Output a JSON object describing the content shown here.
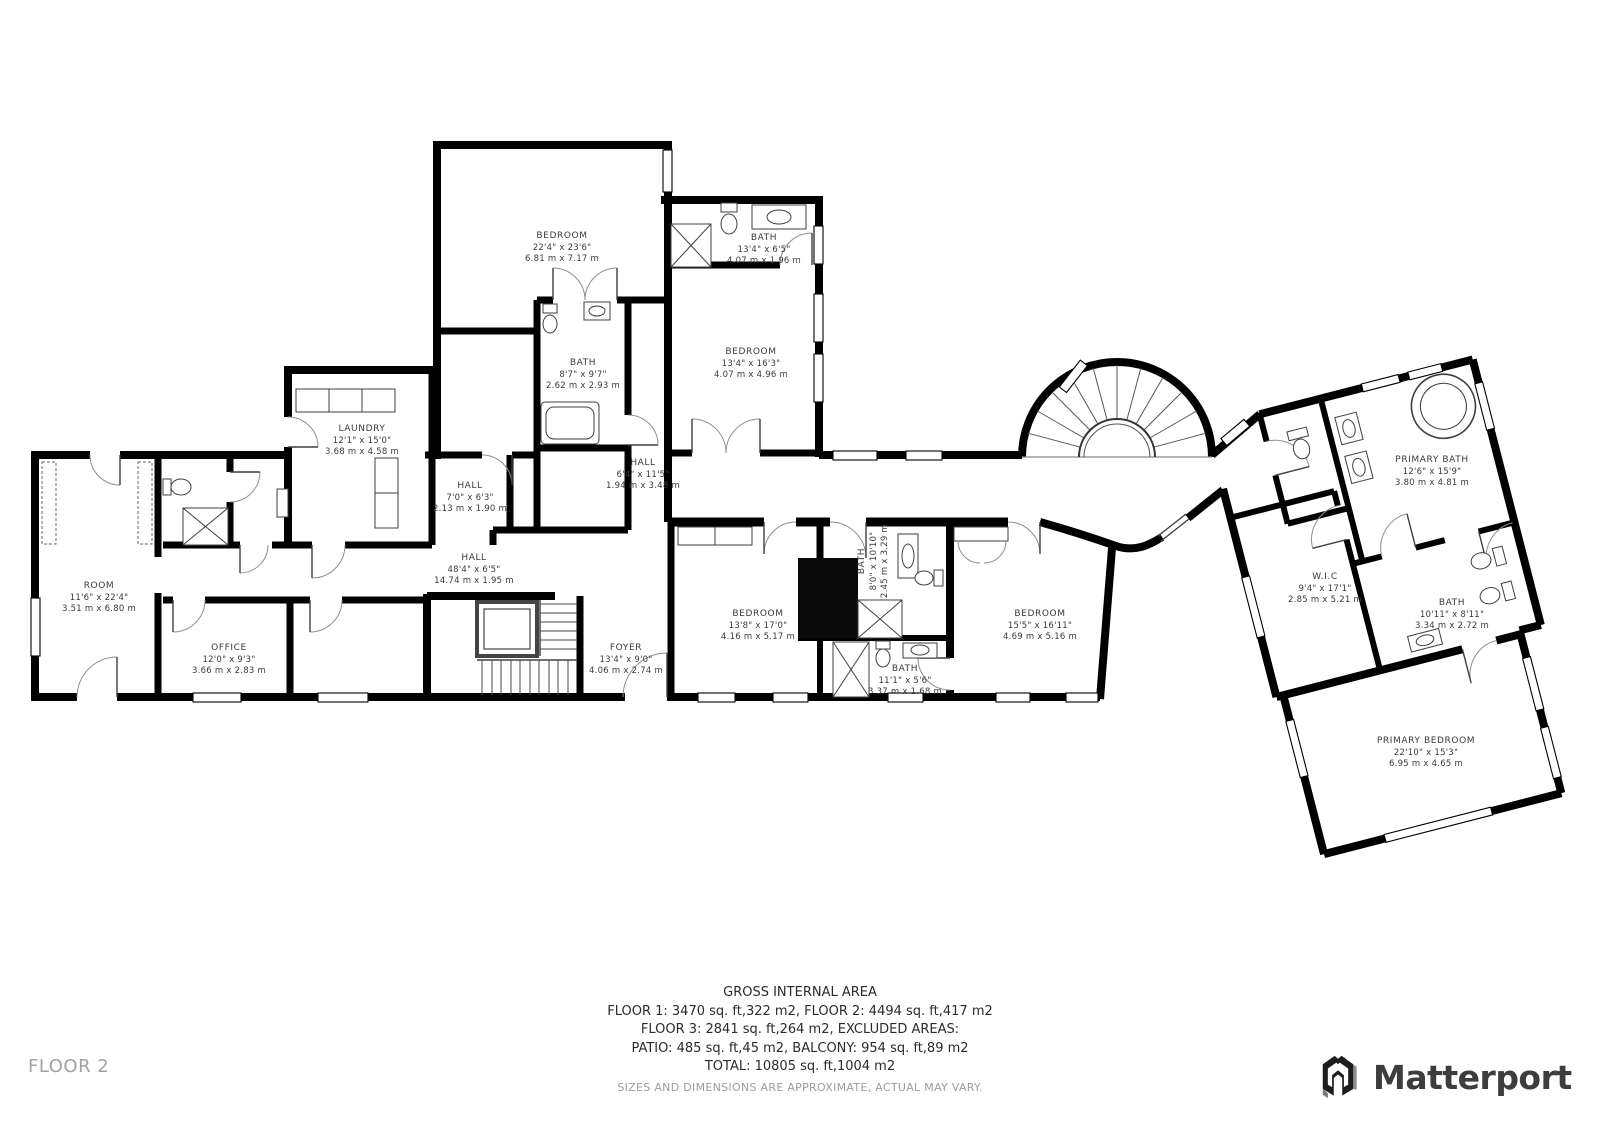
{
  "page": {
    "floor_label": "FLOOR 2"
  },
  "brand": {
    "name": "Matterport"
  },
  "footer": {
    "title": "GROSS INTERNAL AREA",
    "line1": "FLOOR 1: 3470 sq. ft,322 m2, FLOOR 2: 4494 sq. ft,417 m2",
    "line2": "FLOOR 3: 2841 sq. ft,264 m2, EXCLUDED AREAS:",
    "line3": "PATIO: 485 sq. ft,45 m2, BALCONY: 954 sq. ft,89 m2",
    "line4": "TOTAL: 10805 sq. ft,1004 m2",
    "disclaimer": "SIZES AND DIMENSIONS ARE APPROXIMATE, ACTUAL MAY VARY."
  },
  "colors": {
    "wall": "#000000",
    "label": "#3a3a3a",
    "muted": "#a2a2a2",
    "brand": "#3d3d3d"
  },
  "rooms": [
    {
      "id": "bedroom-top",
      "name": "BEDROOM",
      "imperial": "22'4\" x 23'6\"",
      "metric": "6.81 m x 7.17 m",
      "x": 562,
      "y": 248,
      "rot": 0
    },
    {
      "id": "bath-top",
      "name": "BATH",
      "imperial": "13'4\" x 6'5\"",
      "metric": "4.07 m x 1.96 m",
      "x": 764,
      "y": 250,
      "rot": 0
    },
    {
      "id": "bedroom-east",
      "name": "BEDROOM",
      "imperial": "13'4\" x 16'3\"",
      "metric": "4.07 m x 4.96 m",
      "x": 751,
      "y": 364,
      "rot": 0
    },
    {
      "id": "bath-center",
      "name": "BATH",
      "imperial": "8'7\" x 9'7\"",
      "metric": "2.62 m x 2.93 m",
      "x": 583,
      "y": 375,
      "rot": 0
    },
    {
      "id": "laundry",
      "name": "LAUNDRY",
      "imperial": "12'1\" x 15'0\"",
      "metric": "3.68 m x 4.58 m",
      "x": 362,
      "y": 441,
      "rot": 0
    },
    {
      "id": "hall-small",
      "name": "HALL",
      "imperial": "7'0\" x 6'3\"",
      "metric": "2.13 m x 1.90 m",
      "x": 470,
      "y": 498,
      "rot": 0
    },
    {
      "id": "hall-mid",
      "name": "HALL",
      "imperial": "6'4\" x 11'5\"",
      "metric": "1.94 m x 3.48 m",
      "x": 643,
      "y": 475,
      "rot": 0
    },
    {
      "id": "hall-long",
      "name": "HALL",
      "imperial": "48'4\" x 6'5\"",
      "metric": "14.74 m x 1.95 m",
      "x": 474,
      "y": 570,
      "rot": 0
    },
    {
      "id": "room-west",
      "name": "ROOM",
      "imperial": "11'6\" x 22'4\"",
      "metric": "3.51 m x 6.80 m",
      "x": 99,
      "y": 598,
      "rot": 0
    },
    {
      "id": "office",
      "name": "OFFICE",
      "imperial": "12'0\" x 9'3\"",
      "metric": "3.66 m x 2.83 m",
      "x": 229,
      "y": 660,
      "rot": 0
    },
    {
      "id": "foyer",
      "name": "FOYER",
      "imperial": "13'4\" x 9'0\"",
      "metric": "4.06 m x 2.74 m",
      "x": 626,
      "y": 660,
      "rot": 0
    },
    {
      "id": "bedroom-center",
      "name": "BEDROOM",
      "imperial": "13'8\" x 17'0\"",
      "metric": "4.16 m x 5.17 m",
      "x": 758,
      "y": 626,
      "rot": 0
    },
    {
      "id": "bath-vertical",
      "name": "BATH",
      "imperial": "8'0\" x 10'10\"",
      "metric": "2.45 m x 3.29 m",
      "x": 874,
      "y": 561,
      "rot": -90
    },
    {
      "id": "bath-south",
      "name": "BATH",
      "imperial": "11'1\" x 5'6\"",
      "metric": "3.37 m x 1.68 m",
      "x": 905,
      "y": 681,
      "rot": 0
    },
    {
      "id": "bedroom-east2",
      "name": "BEDROOM",
      "imperial": "15'5\" x 16'11\"",
      "metric": "4.69 m x 5.16 m",
      "x": 1040,
      "y": 626,
      "rot": 0
    },
    {
      "id": "primary-bath",
      "name": "PRIMARY BATH",
      "imperial": "12'6\" x 15'9\"",
      "metric": "3.80 m x 4.81 m",
      "x": 1432,
      "y": 472,
      "rot": 0
    },
    {
      "id": "wic",
      "name": "W.I.C",
      "imperial": "9'4\" x 17'1\"",
      "metric": "2.85 m x 5.21 m",
      "x": 1325,
      "y": 589,
      "rot": 0
    },
    {
      "id": "bath-wing",
      "name": "BATH",
      "imperial": "10'11\" x 8'11\"",
      "metric": "3.34 m x 2.72 m",
      "x": 1452,
      "y": 615,
      "rot": 0
    },
    {
      "id": "primary-bedroom",
      "name": "PRIMARY BEDROOM",
      "imperial": "22'10\" x 15'3\"",
      "metric": "6.95 m x 4.65 m",
      "x": 1426,
      "y": 753,
      "rot": 0
    }
  ]
}
